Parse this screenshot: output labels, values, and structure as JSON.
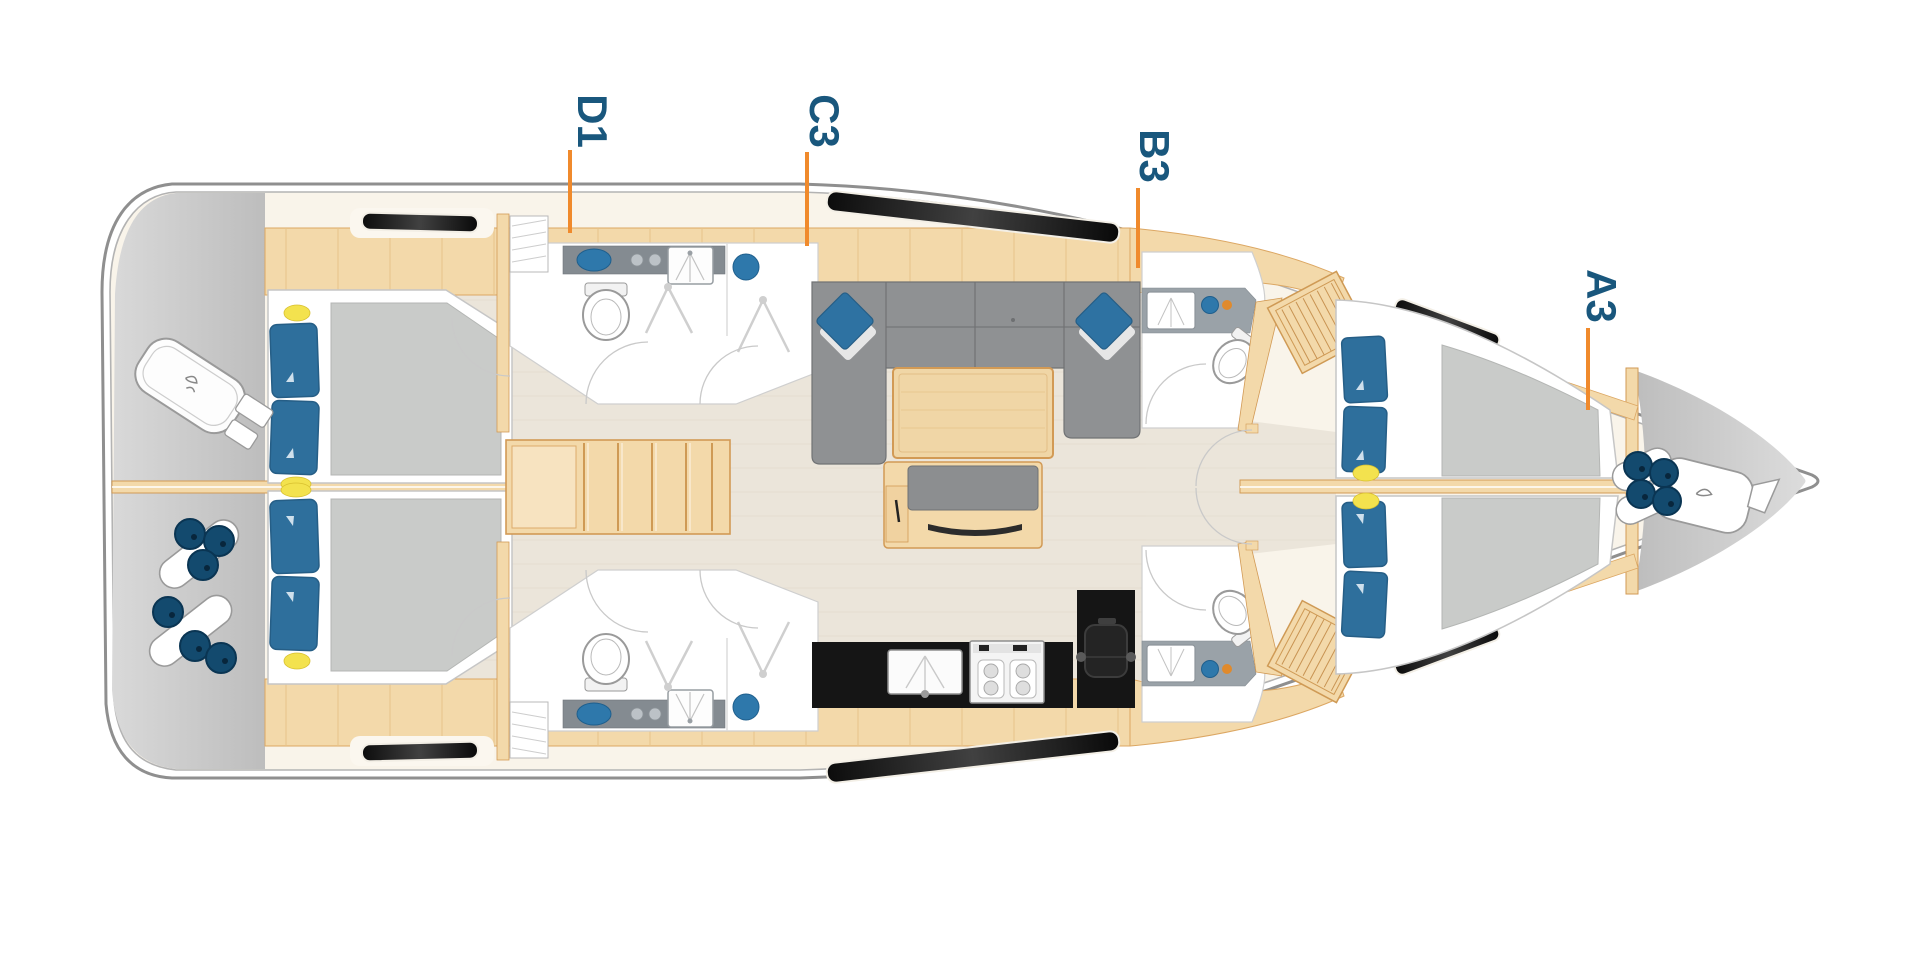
{
  "diagram": {
    "type": "sailing-yacht-interior-deck-plan",
    "orientation": "bow-right",
    "cabin_labels": [
      {
        "id": "D1",
        "label": "D1"
      },
      {
        "id": "C3",
        "label": "C3"
      },
      {
        "id": "B3",
        "label": "B3"
      },
      {
        "id": "A3",
        "label": "A3"
      }
    ],
    "colors": {
      "leader_orange": "#F08A2C",
      "label_blue": "#19577D",
      "pillow_blue": "#2E6F9C",
      "sink_blue": "#2E78AB",
      "fender_navy": "#134A6E",
      "wood_fill": "#F3D9AA",
      "wood_outline": "#D29A55",
      "sofa_grey": "#8F9193",
      "mattress_grey": "#C9CBC9",
      "exterior_deck_grey": "#C6C6C6",
      "galley_black": "#151515",
      "floor_beige": "#EBE5DA",
      "deck_cream": "#F9F4EA",
      "reading_light_yellow": "#F3E24E"
    }
  }
}
